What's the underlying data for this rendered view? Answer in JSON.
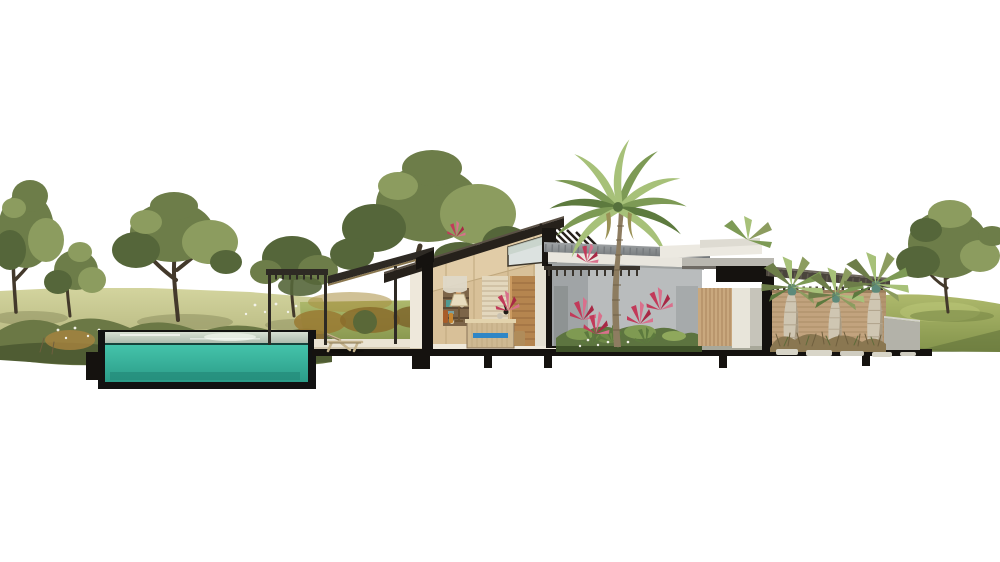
{
  "scene": {
    "background": "#ffffff",
    "colors": {
      "cut_poche": "#15120f",
      "pool_shell": "#121212",
      "pool_water": "#45c4ab",
      "pool_water_deep": "#2b9c88",
      "pool_surface_light": "#d8e0d3",
      "pool_surface_dark": "#a9b8aa",
      "deck": "#eae3d3",
      "meadow_light": "#d3d49e",
      "meadow": "#b2b37b",
      "lawn_light": "#aeb96c",
      "lawn": "#84944c",
      "lawn_shadow": "#5f7038",
      "foliage_dark": "#55663a",
      "foliage_mid": "#6d7d49",
      "foliage_light": "#8c9c5f",
      "trunk_brown": "#43392b",
      "amber_grass": "#a8833e",
      "bush_olive": "#6b7845",
      "flower_white": "#f2f2e8",
      "roof_dark": "#26211b",
      "roof_metal_light": "#a3a6a8",
      "roof_metal_dark": "#6f7376",
      "corrugated_brown": "#4a443c",
      "fascia_white": "#e9e6de",
      "wood_wall": "#d8c098",
      "wood_wall_light": "#e2cda8",
      "wood_door": "#b5854f",
      "louver_panel": "#e3d7bd",
      "earth_wall": "#c2a37e",
      "slat_wood": "#c9a87e",
      "gray_wall": "#b9bcbd",
      "concrete": "#b3b2a9",
      "palm_green": "#7d9a55",
      "palm_light": "#a7c179",
      "palm_trunk": "#8d7c60",
      "bottle_palm_trunk": "#cfc6b2",
      "crownshaft_teal": "#5d8a7a",
      "flower_red": "#c23a5a",
      "flower_pink": "#d9708c",
      "flower_orange": "#cf5a2a",
      "dresser_rattan": "#cfb992",
      "accent_blue": "#2f86c6",
      "dry_grass": "#8a7751",
      "curtain": "#ded8c8",
      "stone_paver": "#d8d5c8"
    },
    "elements": [
      "left-meadow",
      "meadow-trees",
      "wildflower-bushes",
      "swimming-pool-section",
      "pool-step",
      "pool-deck",
      "lounge-chair",
      "pergola",
      "awning",
      "main-house-section",
      "bedroom-interior",
      "shelf-niche",
      "curtain",
      "louver-panel",
      "wood-door",
      "clerestory-window",
      "roof-brise-soleil",
      "table-lamp",
      "rattan-dresser",
      "wall-sconce",
      "courtyard-gray-wall",
      "courtyard-metal-roof",
      "courtyard-trellis",
      "tropical-garden",
      "royal-palm-tree",
      "red-flower-clusters",
      "corridor-wing",
      "entry-cut-beams",
      "corrugated-entry-roof",
      "rammed-earth-wall",
      "bottle-palms",
      "dry-grass-bed",
      "stepping-stones",
      "concrete-retaining-wall",
      "right-lawn",
      "right-tree",
      "ground-slab",
      "foundation-piers"
    ]
  }
}
